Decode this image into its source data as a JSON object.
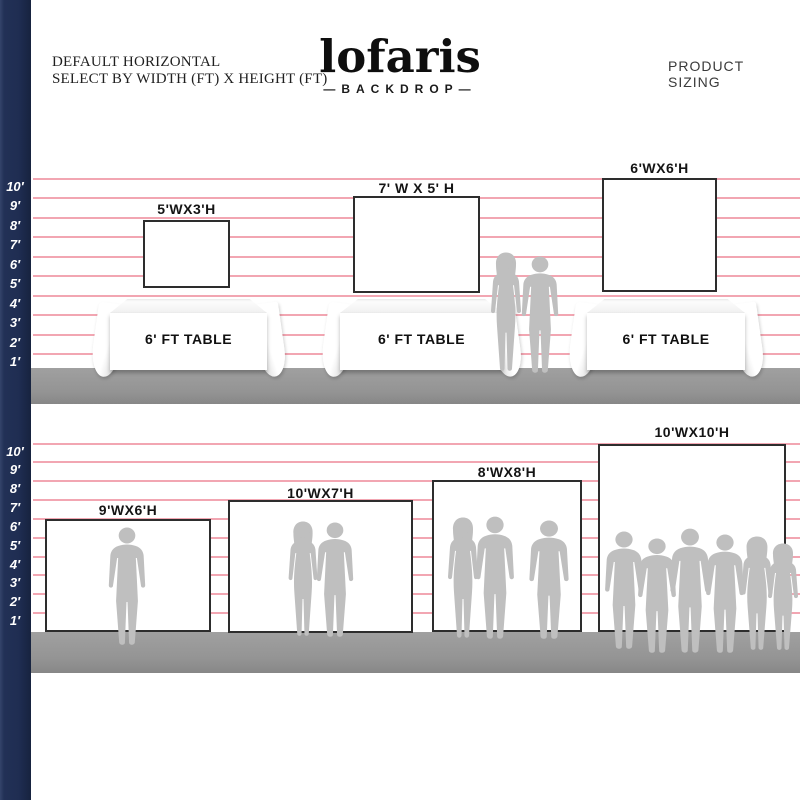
{
  "page": {
    "title_left_line1": "DEFAULT HORIZONTAL",
    "title_left_line2": "SELECT BY WIDTH (FT) X HEIGHT (FT)",
    "product_sizing": "PRODUCT SIZING"
  },
  "logo": {
    "name": "lofaris",
    "sub": "—BACKDROP—"
  },
  "ruler": {
    "unit": "ft",
    "labels": [
      "10′",
      "9′",
      "8′",
      "7′",
      "6′",
      "5′",
      "4′",
      "3′",
      "2′",
      "1′"
    ]
  },
  "sections": [
    {
      "id": "backdrops-with-table",
      "backdrops": [
        "5'WX3'H",
        "7' W X 5' H",
        "6'WX6'H"
      ],
      "table_label": "6' FT TABLE",
      "table_count": 3
    },
    {
      "id": "backdrops-with-people",
      "backdrops": [
        "9'WX6'H",
        "10'WX7'H",
        "8'WX8'H",
        "10'WX10'H"
      ]
    }
  ],
  "colors": {
    "navy": "#1f2d52",
    "grid_pink": "#f2a6b2",
    "floor_gray": "#969696",
    "silhouette_gray": "#bfbfbf",
    "backdrop_border": "#2d2d2d"
  }
}
